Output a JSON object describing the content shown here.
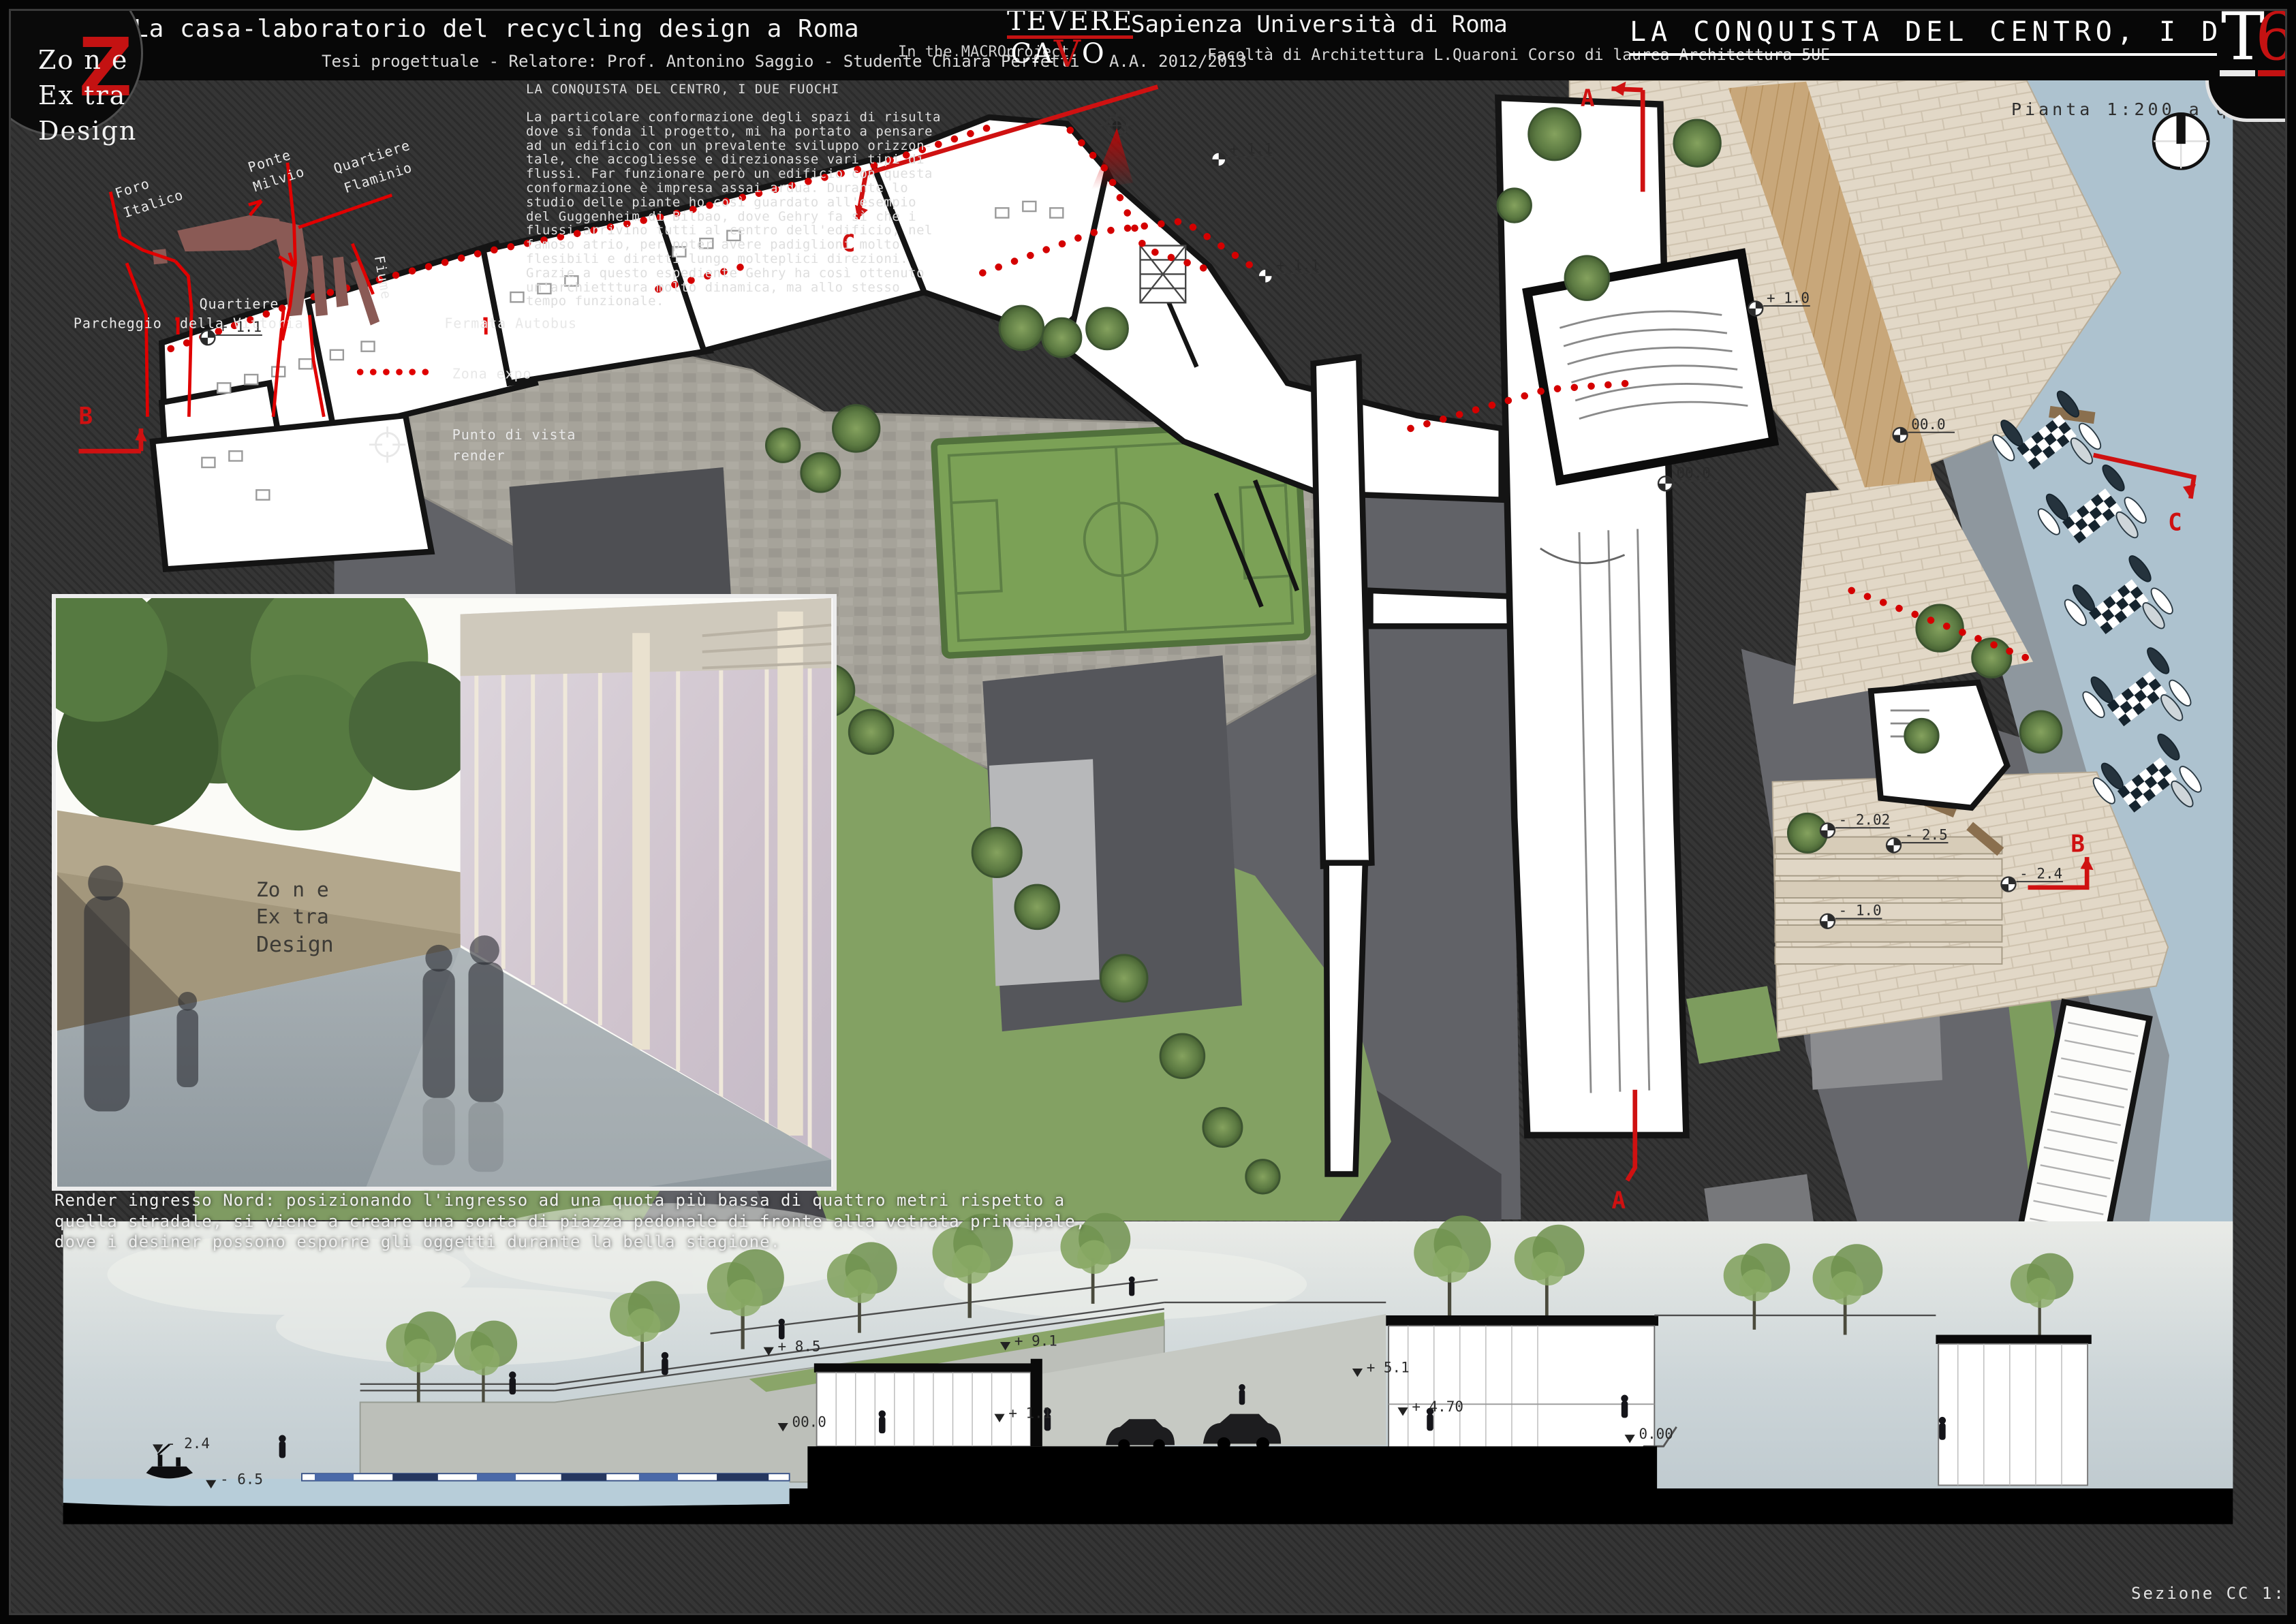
{
  "header": {
    "title": "La casa-laboratorio del recycling design a Roma",
    "subtitle": "Tesi progettuale - Relatore: Prof. Antonino Saggio - Studente Chiara Perfetti - A.A. 2012/2013",
    "macro_label": "In the MACROproject:",
    "tevere": "TEVERE",
    "cavo_ca": "CA",
    "cavo_v": "V",
    "cavo_o": "O",
    "university": "Sapienza Università di Roma",
    "faculty": "Facoltà di Architettura L.Quaroni Corso di laurea Architettura 5UE",
    "board_title": "LA CONQUISTA DEL CENTRO, I DUE FUOCHI",
    "tag_letter": "T",
    "tag_number": "6"
  },
  "logo": {
    "l1": "Zo n e",
    "l2": "Ex tra",
    "l3": "Design",
    "z": "Z"
  },
  "minimap": {
    "foro": "Foro",
    "italico": "Italico",
    "ponte": "Ponte",
    "milvio": "Milvio",
    "quartiere_f": "Quartiere",
    "flaminio": "Flaminio",
    "fiume": "Fiume",
    "parcheggio": "Parcheggio",
    "quartiere_v": "Quartiere",
    "della_vittoria": "della Vittoria",
    "fermata": "Fermata Autobus",
    "zona_expo": "Zona expo",
    "punto_1": "Punto di vista",
    "punto_2": "render"
  },
  "description": {
    "title": "LA CONQUISTA DEL CENTRO, I DUE FUOCHI",
    "body": "La particolare conformazione degli spazi di risulta\ndove si fonda il progetto, mi ha portato a pensare\nad un edificio con un prevalente sviluppo orizzon-\ntale, che accogliesse e direzionasse vari tipi di\nflussi. Far funzionare però un edificio con questa\nconformazione è impresa assai ardua. Durante lo\nstudio delle piante ho così guardato all'esempio\ndel Guggenheim di Bilbao, dove Gehry fa sì che i\nflussi arrivino tutti al centro dell'edificio, nel\nfamoso atrio, per poter avere padiglioni molto\nflesibili e diretti lungo molteplici direzioni.\nGrazie a questo espediente Gehry ha così ottenuto\nun'archietttura molto dinamica, ma allo stesso\ntempo funzionale."
  },
  "plan": {
    "caption": "Pianta 1:200 a quota + 1.5",
    "markers": {
      "a": "A",
      "b": "B",
      "c": "C"
    },
    "levels": [
      "+ 1.1",
      "+ 1.1",
      "+ 1.1",
      "+ 1.0",
      "00.0",
      "00.0",
      "- 2.02",
      "- 2.5",
      "- 1.0",
      "- 2.4"
    ]
  },
  "render": {
    "caption": "Render ingresso Nord: posizionando l'ingresso ad una quota più bassa di quattro metri rispetto a\nquella stradale, si viene a creare una sorta di piazza pedonale di fronte alla vetrata principale,\ndove i desiner possono esporre gli oggetti durante la bella stagione.",
    "wall_logo_1": "Zo n e",
    "wall_logo_2": "Ex tra",
    "wall_logo_3": "Design"
  },
  "section": {
    "caption": "Sezione CC 1:200",
    "levels": [
      "- 2.4",
      "- 6.5",
      "+ 8.5",
      "00.0",
      "+ 9.1",
      "+ 1.1",
      "+ 5.1",
      "+ 4.70",
      "0.00"
    ]
  },
  "colors": {
    "accent_red": "#c41212",
    "river": "#adc2cf",
    "green": "#7d9c5e",
    "beige": "#e2d8c7"
  }
}
